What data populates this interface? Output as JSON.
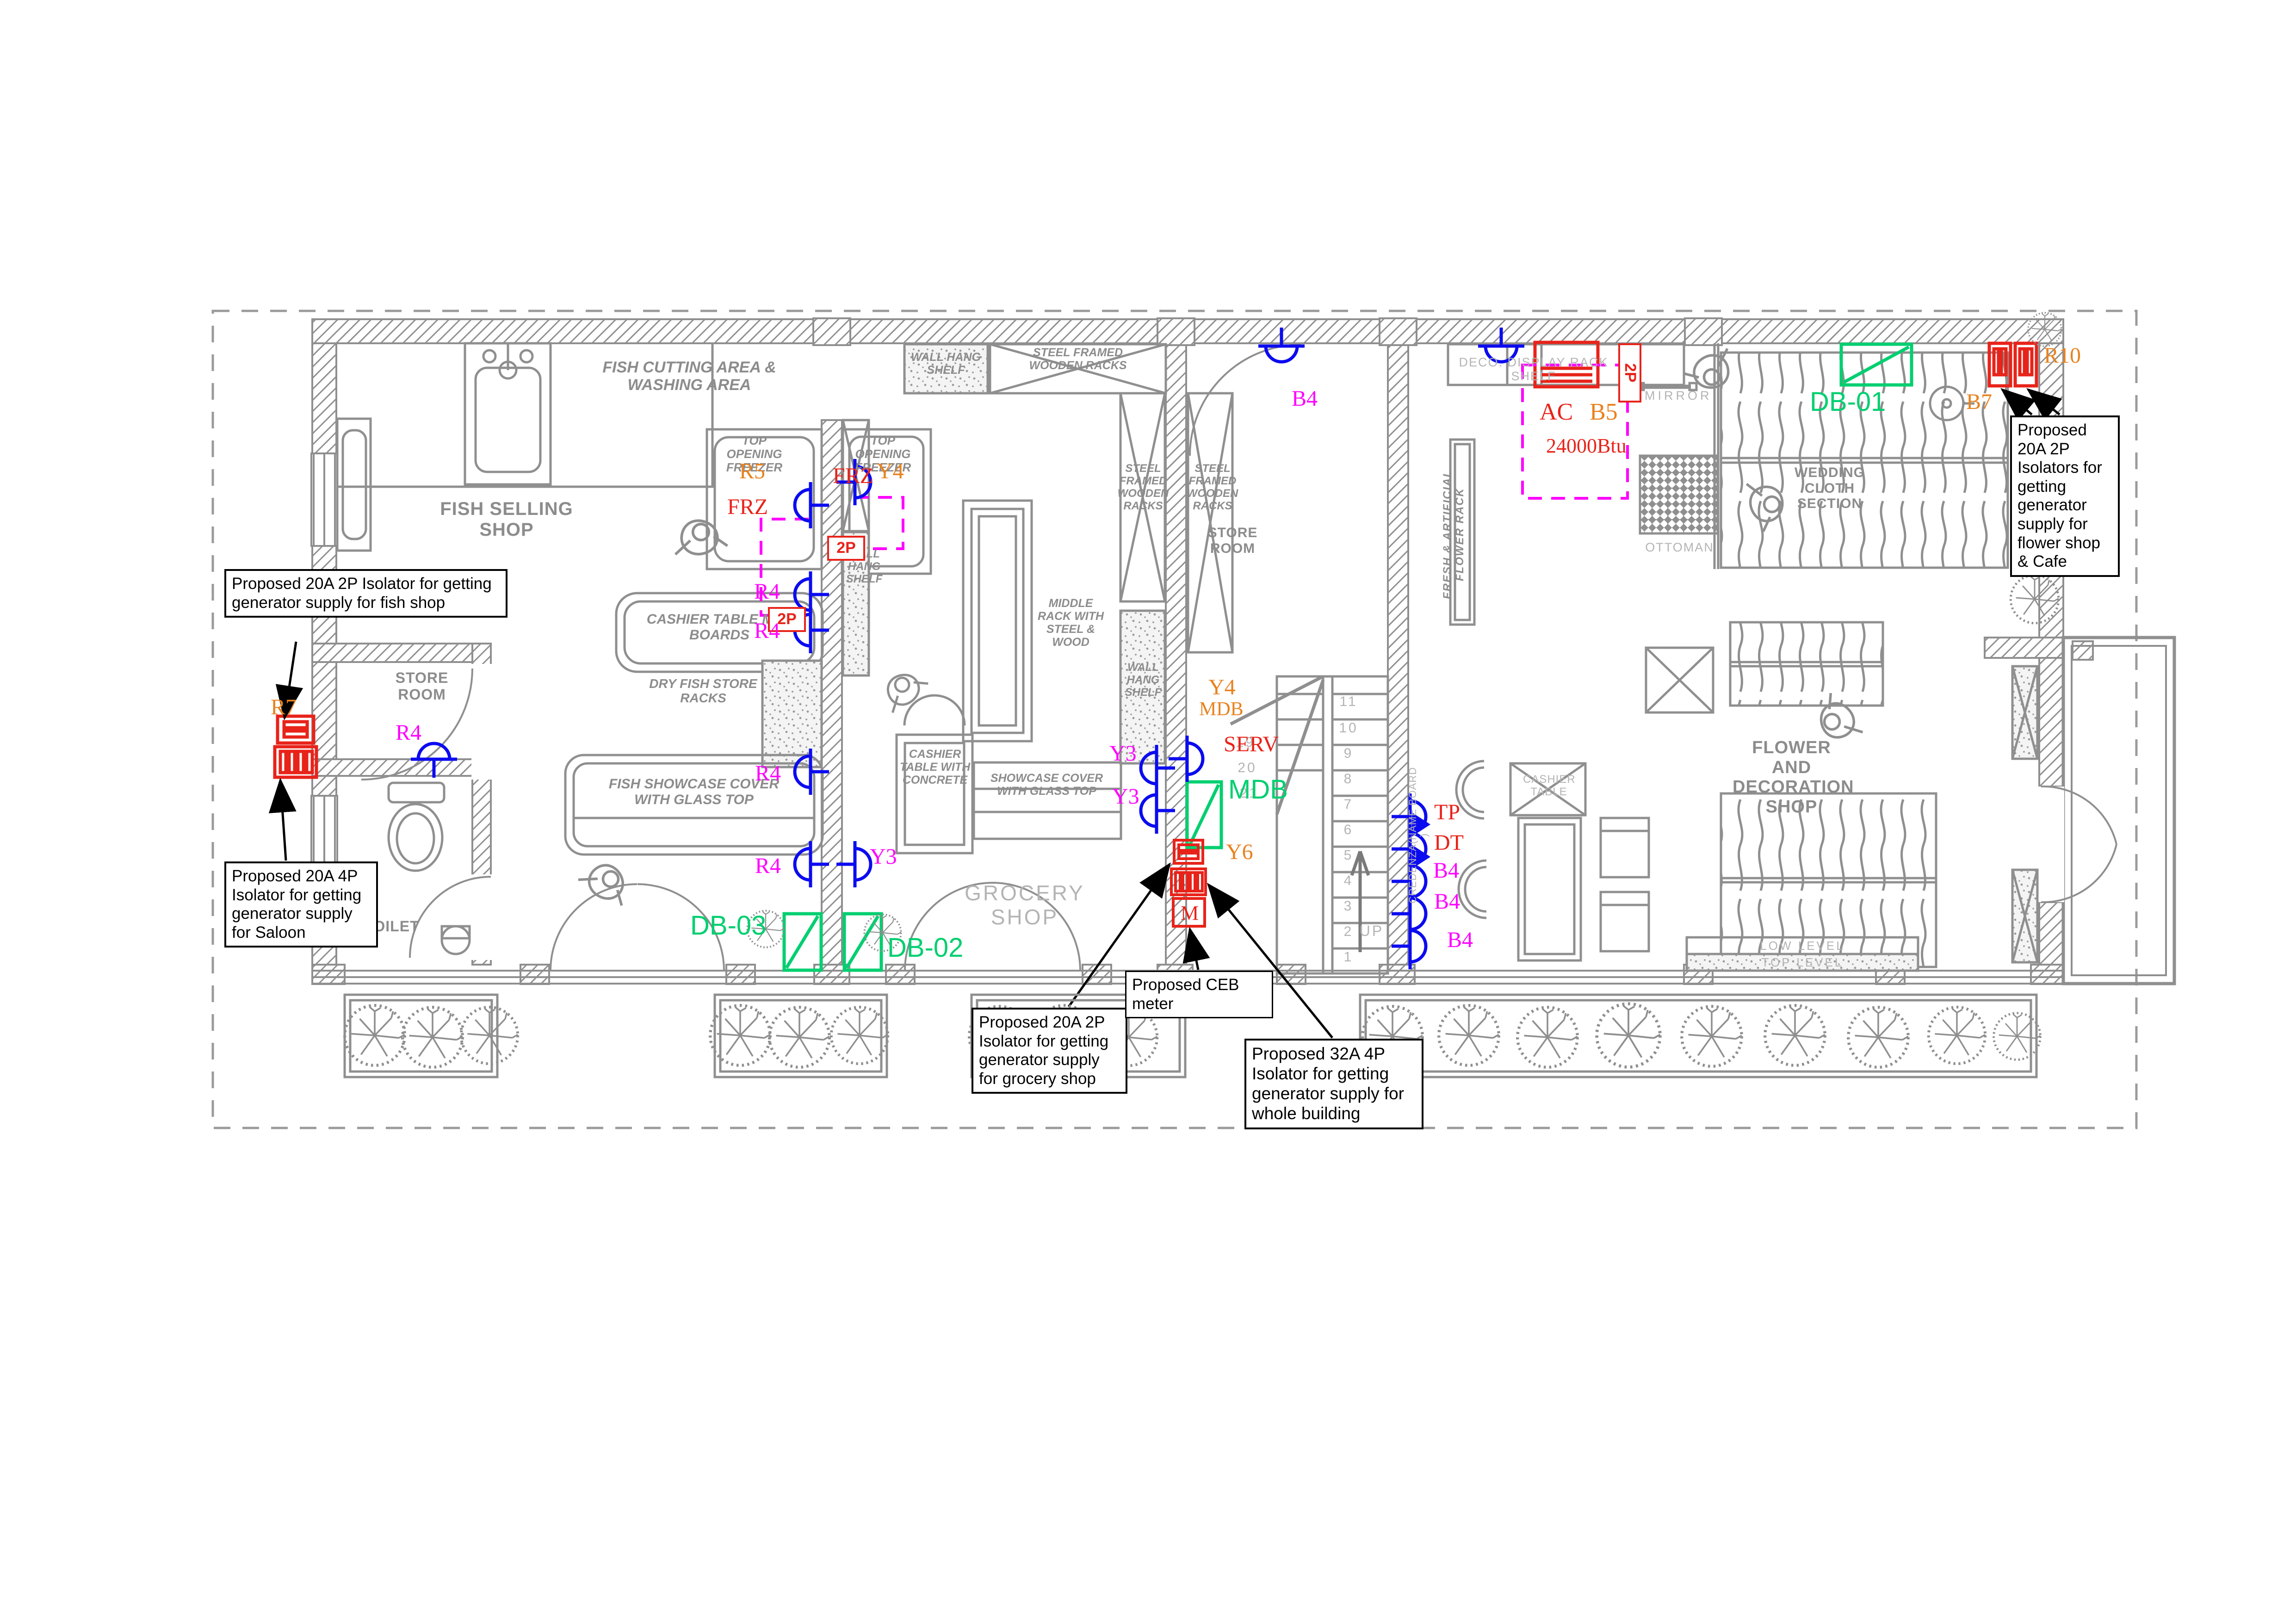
{
  "colors": {
    "wall_gray": "#8f8f8f",
    "label_gray": "#8c8c8c",
    "outline_gray": "#b4b4b4",
    "red": "#e8231a",
    "orange": "#e8821e",
    "magenta": "#ff00ff",
    "green": "#00cf70",
    "blue": "#0b0bf0"
  },
  "annotations": {
    "fish_shop": "Proposed 20A 2P Isolator for getting generator supply for fish shop",
    "saloon": "Proposed 20A 4P Isolator for getting generator supply for Saloon",
    "grocery_shop": "Proposed 20A 2P Isolator for getting generator supply for grocery shop",
    "ceb_meter": "Proposed CEB meter",
    "whole_building": "Proposed 32A 4P Isolator for getting generator supply for whole building",
    "flower_cafe": "Proposed 20A 2P Isolators for getting generator supply for flower shop & Cafe"
  },
  "rooms": {
    "fish_selling": "FISH SELLING SHOP",
    "fish_cutting": "FISH CUTTING AREA & WASHING AREA",
    "store_room": "STORE ROOM",
    "toilet": "TOILET",
    "grocery": "GROCERY SHOP",
    "flower": "FLOWER AND DECORATION SHOP",
    "wedding": "WEDDING CLOTH SECTION"
  },
  "furniture": {
    "top_freezer": "TOP OPENING FREEZER",
    "wall_hang": "WALL HANG SHELF",
    "sfwr": "STEEL FRAMED WOODEN RACKS",
    "middle_rack": "MIDDLE RACK WITH STEEL & WOOD",
    "cashier_mdf": "CASHIER TABLE MDF BOARDS",
    "dry_fish": "DRY FISH STORE RACKS",
    "fish_showcase": "FISH SHOWCASE COVER WITH GLASS TOP",
    "cashier_concrete": "CASHIER TABLE WITH CONCRETE",
    "showcase": "SHOWCASE COVER WITH GLASS TOP",
    "fresh_flower": "FRESH & ARTIFICIAL FLOWER RACK",
    "deco_shelf": "DECO. DISPLAY RACK SHELF",
    "mirror": "MIRROR",
    "ottoman": "OTTOMAN",
    "cashier_cafe": "CASHIER TABLE",
    "credenza": "CREDENZA(NAME BOARD )",
    "low_level": "LOW LEVEL",
    "top_level": "TOP LEVEL"
  },
  "electrical": {
    "r5": "R5",
    "frz": "FRZ",
    "y4": "Y4",
    "two_p": "2P",
    "r4": "R4",
    "y3": "Y3",
    "r7": "R7",
    "r10": "R10",
    "b7": "B7",
    "b4": "B4",
    "y6": "Y6",
    "tp": "TP",
    "dt": "DT",
    "serv": "SERV",
    "mdb": "MDB",
    "meter": "M",
    "ac": "AC",
    "b5": "B5",
    "btu": "24000Btu",
    "db01": "DB-01",
    "db02": "DB-02",
    "db03": "DB-03"
  },
  "stairs": {
    "up": "UP",
    "flight_a": [
      "1",
      "2",
      "3",
      "4",
      "5",
      "6",
      "7",
      "8",
      "9",
      "10",
      "11"
    ],
    "flight_b": [
      "19",
      "20",
      "21"
    ]
  }
}
